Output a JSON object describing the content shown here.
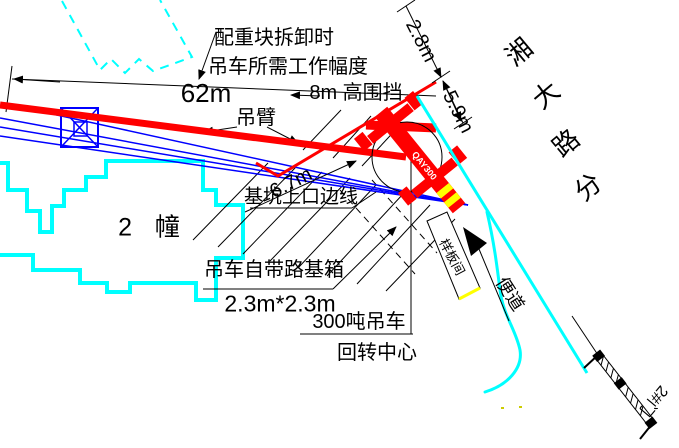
{
  "drawing": {
    "type": "construction-site-plan",
    "colors": {
      "building_outline": "#00ffff",
      "crane_red": "#ff0000",
      "boom_blue": "#0000ff",
      "stripe_yellow": "#ffff00",
      "line_black": "#000000"
    }
  },
  "labels": [
    {
      "name": "note-counterweight-line1",
      "text": "配重块拆卸时",
      "x": 274,
      "y": 38,
      "size": 20,
      "rot": 0,
      "color": "#000"
    },
    {
      "name": "note-counterweight-line2",
      "text": "吊车所需工作幅度",
      "x": 288,
      "y": 67,
      "size": 20,
      "rot": 0,
      "color": "#000"
    },
    {
      "name": "dim-62m",
      "text": "62m",
      "x": 206,
      "y": 93,
      "size": 26,
      "rot": 0,
      "color": "#000"
    },
    {
      "name": "label-8m-fence",
      "text": "8m 高围挡",
      "x": 356,
      "y": 93,
      "size": 20,
      "rot": 0,
      "color": "#000"
    },
    {
      "name": "label-boom",
      "text": "吊臂",
      "x": 256,
      "y": 118,
      "size": 20,
      "rot": 0,
      "color": "#000"
    },
    {
      "name": "dim-2-8m",
      "text": "2.8m",
      "x": 421,
      "y": 41,
      "size": 20,
      "rot": 63,
      "color": "#000"
    },
    {
      "name": "dim-5-9m",
      "text": "5.9m",
      "x": 458,
      "y": 112,
      "size": 20,
      "rot": 63,
      "color": "#000"
    },
    {
      "name": "dim-6-7m",
      "text": "6.7m",
      "x": 291,
      "y": 183,
      "size": 20,
      "rot": -27,
      "color": "#000"
    },
    {
      "name": "label-pit-edge",
      "text": "基坑上口边线",
      "x": 301,
      "y": 197,
      "size": 19,
      "rot": 0,
      "color": "#000"
    },
    {
      "name": "label-building-2",
      "text": "2 幢",
      "x": 153,
      "y": 228,
      "size": 25,
      "rot": 0,
      "ls": 8,
      "color": "#000"
    },
    {
      "name": "label-roadbase-box",
      "text": "吊车自带路基箱",
      "x": 274,
      "y": 270,
      "size": 20,
      "rot": 0,
      "color": "#000"
    },
    {
      "name": "dim-roadbase-size",
      "text": "2.3m*2.3m",
      "x": 280,
      "y": 304,
      "size": 23,
      "rot": 0,
      "color": "#000"
    },
    {
      "name": "label-300t-crane",
      "text": "300吨吊车",
      "x": 359,
      "y": 322,
      "size": 20,
      "rot": 0,
      "color": "#000"
    },
    {
      "name": "label-rotation-center",
      "text": "回转中心",
      "x": 377,
      "y": 353,
      "size": 20,
      "rot": 0,
      "color": "#000"
    },
    {
      "name": "label-access-road",
      "text": "便道",
      "x": 510,
      "y": 294,
      "size": 18,
      "rot": 57,
      "color": "#000"
    },
    {
      "name": "label-sample-room",
      "text": "样板间",
      "x": 452,
      "y": 257,
      "size": 13,
      "rot": 62,
      "color": "#000"
    },
    {
      "name": "street-name-char1",
      "text": "湘",
      "x": 519,
      "y": 52,
      "size": 26,
      "rot": -40,
      "color": "#000"
    },
    {
      "name": "street-name-char2",
      "text": "大",
      "x": 546,
      "y": 95,
      "size": 26,
      "rot": -40,
      "color": "#000"
    },
    {
      "name": "street-name-char3",
      "text": "路",
      "x": 566,
      "y": 143,
      "size": 26,
      "rot": -40,
      "color": "#000"
    },
    {
      "name": "street-name-char4",
      "text": "分",
      "x": 588,
      "y": 187,
      "size": 26,
      "rot": -40,
      "color": "#000"
    },
    {
      "name": "label-gate-2",
      "text": "2#门",
      "x": 653,
      "y": 400,
      "size": 16,
      "rot": 130,
      "color": "#000"
    },
    {
      "name": "crane-model-text",
      "text": "QAY300",
      "x": 424,
      "y": 166,
      "size": 9,
      "rot": 51,
      "color": "#fff",
      "bold": true
    }
  ]
}
